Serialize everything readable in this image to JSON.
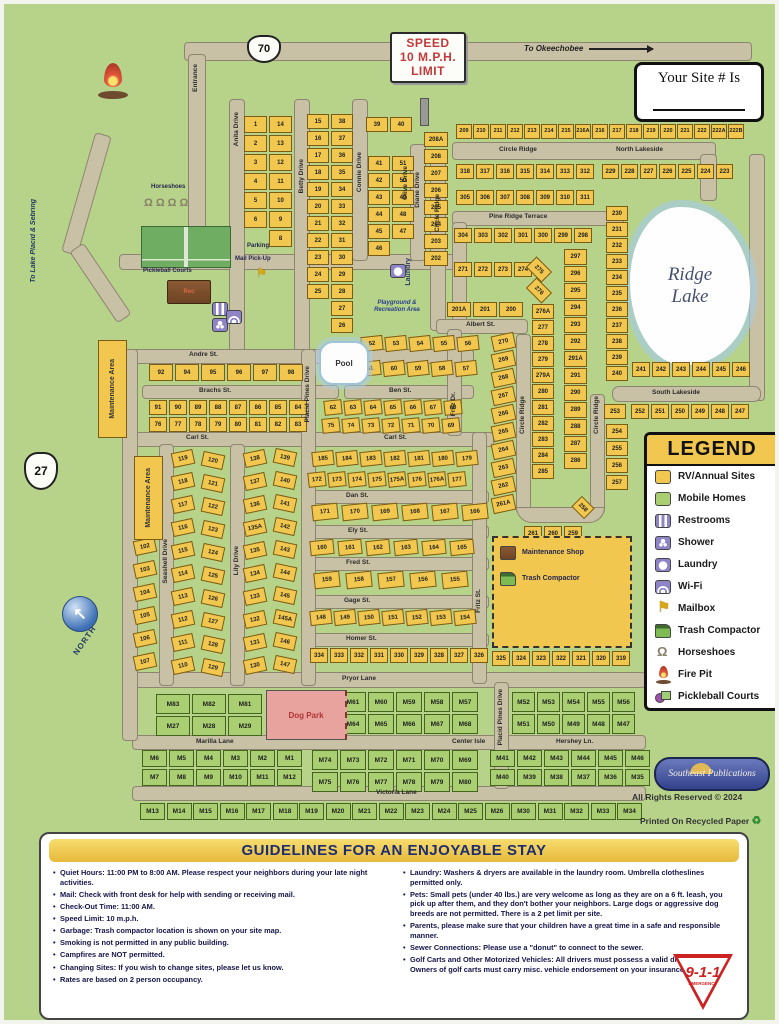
{
  "signs": {
    "speed_lines": [
      "SPEED",
      "10 M.P.H.",
      "LIMIT"
    ],
    "route70": "70",
    "route27": "27",
    "to_okeechobee": "To Okeechobee",
    "to_lake_placid": "To Lake Placid & Sebring",
    "north": "NORTH",
    "your_site": "Your Site # Is"
  },
  "places": {
    "lake1": "Ridge",
    "lake2": "Lake",
    "pool": "Pool",
    "laundry": "Laundry",
    "parking": "Parking",
    "mail_pickup": "Mail Pick-Up",
    "horseshoes": "Horseshoes",
    "pickleball": "Pickleball Courts",
    "playground": "Playground & Recreation Area",
    "rec_hall": "Rec",
    "dog_park": "Dog Park",
    "maintenance_area": "Maintenance Area",
    "maintenance_shop": "Maintenance Shop",
    "trash_compactor": "Trash Compactor"
  },
  "streets": {
    "entrance": "Entrance",
    "anita": "Anita Drive",
    "betty": "Betty Drive",
    "connie": "Connie Drive",
    "olive": "Olive Drive",
    "diane": "Diane Drive",
    "circle_ridge": "Circle Ridge",
    "north_lakeside": "North Lakeside",
    "south_lakeside": "South Lakeside",
    "pine_ridge": "Pine Ridge Terrace",
    "albert": "Albert St.",
    "andre": "Andre St.",
    "brachs": "Brachs St.",
    "ben": "Ben St.",
    "carl": "Carl St.",
    "dan": "Dan St.",
    "ely": "Ely St.",
    "fred": "Fred St.",
    "gage": "Gage St.",
    "homer": "Homer St.",
    "pryor": "Pryor Lane",
    "marilla": "Marilla Lane",
    "center_isle": "Center Isle",
    "hershey": "Hershey Ln.",
    "victoria": "Victoria Lane",
    "seashell": "Seashell Drive",
    "lily": "Lily Drive",
    "placid_pines": "Placid Pines Drive",
    "fritz_dr": "Fritz Dr.",
    "fritz_st": "Fritz St."
  },
  "lots": {
    "anita_block": [
      "1",
      "14",
      "2",
      "13",
      "3",
      "12",
      "4",
      "11",
      "5",
      "10",
      "6",
      "9",
      "",
      "8"
    ],
    "betty_block": [
      "15",
      "38",
      "16",
      "37",
      "17",
      "36",
      "18",
      "35",
      "19",
      "34",
      "20",
      "33",
      "21",
      "32",
      "22",
      "31",
      "23",
      "30",
      "24",
      "29",
      "25",
      "28",
      "",
      "27",
      "",
      "26"
    ],
    "connie_top": [
      "39",
      "40"
    ],
    "connie_block": [
      "41",
      "51",
      "42",
      "50",
      "43",
      "49",
      "44",
      "48",
      "45",
      "47",
      "46",
      ""
    ],
    "diane_col": [
      "208A",
      "208",
      "207",
      "206",
      "205",
      "204",
      "203",
      "202"
    ],
    "albert_row": [
      "201A",
      "201",
      "200"
    ],
    "north_row": [
      "209",
      "210",
      "211",
      "212",
      "213",
      "214",
      "215",
      "216A",
      "216",
      "217",
      "218",
      "219",
      "220",
      "221",
      "222",
      "222A",
      "222B"
    ],
    "circle_inner_row1": [
      "318",
      "317",
      "316",
      "315",
      "314",
      "313",
      "312"
    ],
    "circle_inner_row2": [
      "305",
      "306",
      "307",
      "308",
      "309",
      "310",
      "311"
    ],
    "north_lakeside_row": [
      "229",
      "228",
      "227",
      "226",
      "225",
      "224",
      "223"
    ],
    "pine_ridge_row": [
      "304",
      "303",
      "302",
      "301",
      "300",
      "299",
      "298"
    ],
    "row_271": [
      "271",
      "272",
      "273",
      "274"
    ],
    "diag_275": [
      "275",
      "276"
    ],
    "lake_col": [
      "230",
      "231",
      "232",
      "233",
      "234",
      "235",
      "236",
      "237",
      "238",
      "239",
      "240"
    ],
    "lake_row": [
      "241",
      "242",
      "243",
      "244",
      "245",
      "246"
    ],
    "south_253": [
      "253"
    ],
    "south_row": [
      "252",
      "251",
      "250",
      "249",
      "248",
      "247"
    ],
    "east_col": [
      "254",
      "255",
      "256",
      "257"
    ],
    "diag_258": [
      "258"
    ],
    "bottom_row_259": [
      "261",
      "260",
      "259"
    ],
    "fritz_diag_col": [
      "270",
      "269",
      "268",
      "267",
      "266",
      "265",
      "264",
      "263",
      "262",
      "261A"
    ],
    "ridge_west_col": [
      "276A",
      "277",
      "278",
      "279",
      "279A",
      "280",
      "281",
      "282",
      "283",
      "284",
      "285"
    ],
    "ridge_east_col": [
      "297",
      "296",
      "295",
      "294",
      "293",
      "292",
      "291A",
      "291",
      "290",
      "289",
      "288",
      "287",
      "286"
    ],
    "pool_row1": [
      "52",
      "53",
      "54",
      "55",
      "56"
    ],
    "pool_row2": [
      "61",
      "60",
      "59",
      "58",
      "57"
    ],
    "ben_row1": [
      "62",
      "63",
      "64",
      "65",
      "66",
      "67",
      "68"
    ],
    "ben_row2": [
      "75",
      "74",
      "73",
      "72",
      "71",
      "70",
      "69"
    ],
    "andre_row": [
      "92",
      "94",
      "95",
      "96",
      "97",
      "98"
    ],
    "brachs_row1": [
      "91",
      "90",
      "89",
      "88",
      "87",
      "86",
      "85",
      "84"
    ],
    "brachs_row2": [
      "76",
      "77",
      "78",
      "79",
      "80",
      "81",
      "82",
      "83"
    ],
    "west_col": [
      "102",
      "103",
      "104",
      "105",
      "106",
      "107"
    ],
    "seashell_col1": [
      "119",
      "118",
      "117",
      "116",
      "115",
      "114",
      "113",
      "112",
      "111",
      "110"
    ],
    "seashell_col2": [
      "120",
      "121",
      "122",
      "123",
      "124",
      "125",
      "126",
      "127",
      "128",
      "129"
    ],
    "lily_col1": [
      "138",
      "137",
      "136",
      "135A",
      "135",
      "134",
      "133",
      "132",
      "131",
      "130"
    ],
    "lily_col2": [
      "139",
      "140",
      "141",
      "142",
      "143",
      "144",
      "145",
      "145A",
      "146",
      "147"
    ],
    "carl_row1": [
      "185",
      "184",
      "183",
      "182",
      "181",
      "180",
      "179"
    ],
    "carl_row2": [
      "172",
      "173",
      "174",
      "175",
      "175A",
      "176",
      "176A",
      "177"
    ],
    "dan_row": [
      "171",
      "170",
      "169",
      "168",
      "167",
      "166"
    ],
    "ely_row": [
      "160",
      "161",
      "162",
      "163",
      "164",
      "165"
    ],
    "fred_row": [
      "159",
      "158",
      "157",
      "156",
      "155"
    ],
    "gage_row": [
      "148",
      "149",
      "150",
      "151",
      "152",
      "153",
      "154"
    ],
    "homer_row": [
      "334",
      "333",
      "332",
      "331",
      "330",
      "329",
      "328",
      "327",
      "326"
    ],
    "pryor_row": [
      "325",
      "324",
      "323",
      "322",
      "321",
      "320",
      "319"
    ]
  },
  "mobile": {
    "nw_block": [
      "M83",
      "M82",
      "M81",
      "M27",
      "M28",
      "M29"
    ],
    "n_mid_block": [
      "M62",
      "M61",
      "M60",
      "M59",
      "M58",
      "M57",
      "M63",
      "M64",
      "M65",
      "M66",
      "M67",
      "M68"
    ],
    "n_right_block": [
      "M52",
      "M53",
      "M54",
      "M55",
      "M56",
      "M51",
      "M50",
      "M49",
      "M48",
      "M47"
    ],
    "s_left_block": [
      "M6",
      "M5",
      "M4",
      "M3",
      "M2",
      "M1",
      "M7",
      "M8",
      "M9",
      "M10",
      "M11",
      "M12"
    ],
    "s_mid_block": [
      "M74",
      "M73",
      "M72",
      "M71",
      "M70",
      "M69",
      "M75",
      "M76",
      "M77",
      "M78",
      "M79",
      "M80"
    ],
    "s_right_block": [
      "M41",
      "M42",
      "M43",
      "M44",
      "M45",
      "M46",
      "M40",
      "M39",
      "M38",
      "M37",
      "M36",
      "M35"
    ],
    "bottom_row": [
      "M13",
      "M14",
      "M15",
      "M16",
      "M17",
      "M18",
      "M19",
      "M20",
      "M21",
      "M22",
      "M23",
      "M24",
      "M25",
      "M26",
      "M30",
      "M31",
      "M32",
      "M33",
      "M34"
    ]
  },
  "legend": {
    "title": "LEGEND",
    "items": [
      {
        "icon": "rv-site",
        "label": "RV/Annual Sites"
      },
      {
        "icon": "mobile-home",
        "label": "Mobile Homes"
      },
      {
        "icon": "restrooms",
        "label": "Restrooms"
      },
      {
        "icon": "shower",
        "label": "Shower"
      },
      {
        "icon": "laundry",
        "label": "Laundry"
      },
      {
        "icon": "wifi",
        "label": "Wi-Fi"
      },
      {
        "icon": "mailbox",
        "label": "Mailbox"
      },
      {
        "icon": "trash-compactor",
        "label": "Trash Compactor"
      },
      {
        "icon": "horseshoes",
        "label": "Horseshoes"
      },
      {
        "icon": "fire-pit",
        "label": "Fire Pit"
      },
      {
        "icon": "pickleball",
        "label": "Pickleball Courts"
      }
    ]
  },
  "guidelines": {
    "title": "GUIDELINES FOR AN ENJOYABLE STAY",
    "left": [
      {
        "b": "Quiet Hours:",
        "t": " 11:00 PM to 8:00 AM. Please respect your neighbors during your late night activities."
      },
      {
        "b": "Mail:",
        "t": " Check with front desk for help with sending or receiving mail."
      },
      {
        "b": "Check-Out Time:",
        "t": " 11:00 AM."
      },
      {
        "b": "Speed Limit:",
        "t": " 10 m.p.h."
      },
      {
        "b": "Garbage:",
        "t": " Trash compactor location is shown on your site map."
      },
      {
        "b": "",
        "t": "Smoking is not permitted in any public building."
      },
      {
        "b": "",
        "t": "Campfires are NOT permitted."
      },
      {
        "b": "Changing Sites:",
        "t": " If you wish to change sites, please let us know."
      },
      {
        "b": "",
        "t": "Rates are based on 2 person occupancy."
      }
    ],
    "right": [
      {
        "b": "Laundry:",
        "t": " Washers & dryers are available in the laundry room. Umbrella clotheslines permitted only."
      },
      {
        "b": "Pets:",
        "t": " Small pets (under 40 lbs.) are very welcome as long as they are on a 6 ft. leash, you pick up after them, and they don't bother your neighbors. Large dogs or aggressive dog breeds are not permitted. There is a 2 pet limit per site."
      },
      {
        "b": "Parents,",
        "t": " please make sure that your children have a great time in a safe and responsible manner."
      },
      {
        "b": "Sewer Connections:",
        "t": " Please use a \"donut\" to connect to the sewer."
      },
      {
        "b": "Golf Carts and Other Motorized Vehicles:",
        "t": " All drivers must possess a valid driver's license. Owners of golf carts must carry misc. vehicle endorsement on your insurance policy."
      }
    ]
  },
  "footer": {
    "publisher": "Southeast Publications",
    "rights": "All Rights Reserved © 2024",
    "recycled": "Printed On Recycled Paper",
    "emergency": "9-1-1",
    "emergency_sub": "EMERGENCY"
  },
  "colors": {
    "rv_yellow": "#F1C74F",
    "mobile_green": "#A9CF72",
    "road_tan": "#C9C1A6",
    "background_green": "#B7D38A",
    "lake_blue": "#A5CBE3",
    "amenity_purple": "#8E85C8",
    "dog_park_pink": "#E9A39E",
    "header_navy": "#1D2D71"
  }
}
